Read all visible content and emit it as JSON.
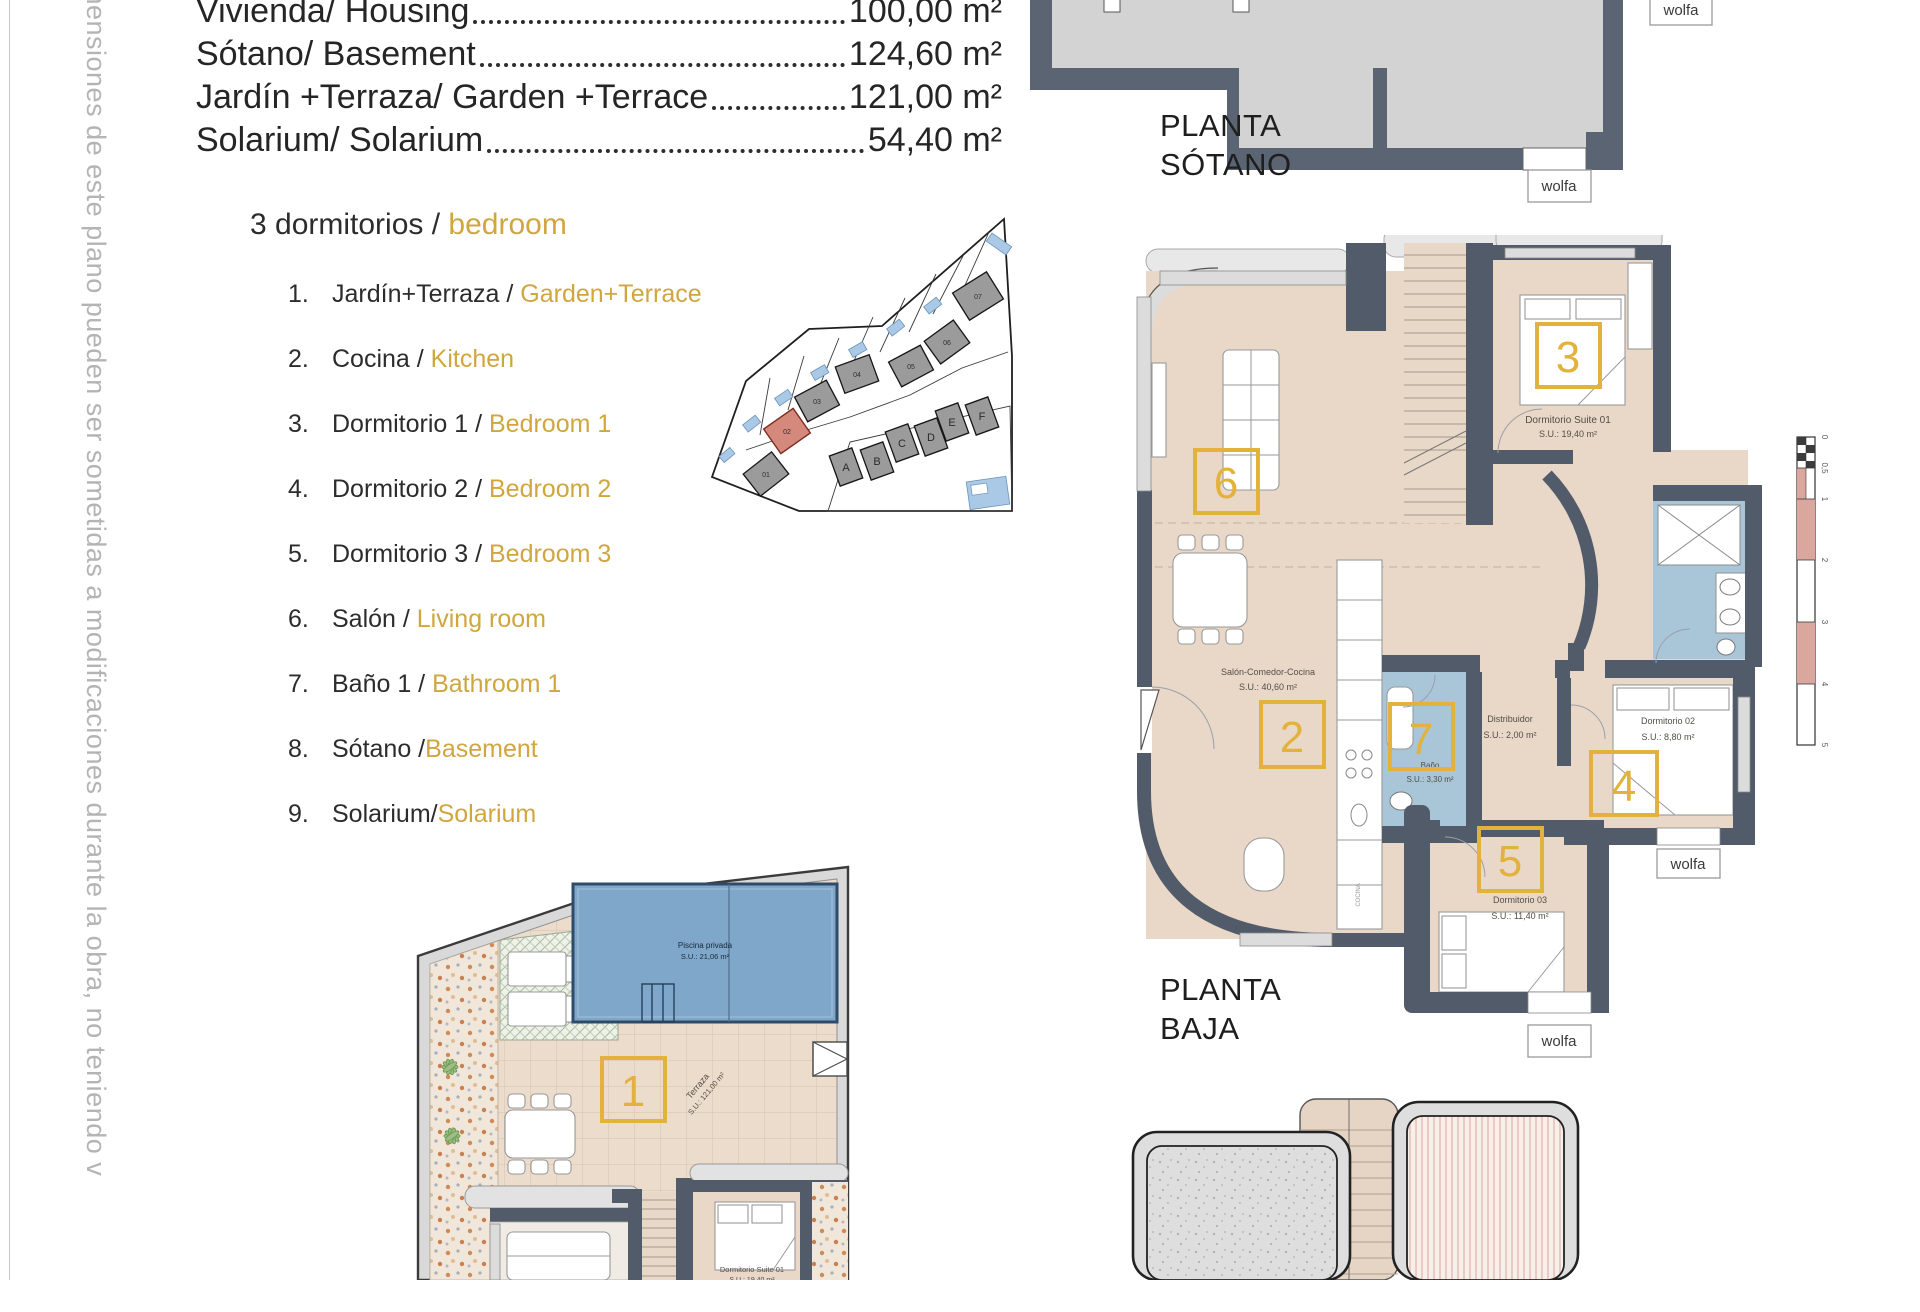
{
  "side_note": "mensiones de este plano pueden ser sometidas a modificaciones durante la obra, no teniendo v",
  "wolfa_label": "wolfa",
  "area_summary": {
    "rows": [
      {
        "label": "Vivienda/ Housing",
        "value": "100,00 m²"
      },
      {
        "label": "Sótano/ Basement",
        "value": "124,60 m²"
      },
      {
        "label": "Jardín +Terraza/ Garden +Terrace",
        "value": "121,00 m²"
      },
      {
        "label": "Solarium/ Solarium",
        "value": "54,40 m²"
      }
    ]
  },
  "legend": {
    "title_es": "3 dormitorios / ",
    "title_en": "bedroom",
    "items": [
      {
        "num": "1.",
        "es": "Jardín+Terraza / ",
        "en": "Garden+Terrace"
      },
      {
        "num": "2.",
        "es": "Cocina / ",
        "en": "Kitchen"
      },
      {
        "num": "3.",
        "es": "Dormitorio 1 / ",
        "en": "Bedroom 1"
      },
      {
        "num": "4.",
        "es": "Dormitorio 2 / ",
        "en": "Bedroom 2"
      },
      {
        "num": "5.",
        "es": "Dormitorio 3 / ",
        "en": "Bedroom 3"
      },
      {
        "num": "6.",
        "es": "Salón / ",
        "en": "Living room"
      },
      {
        "num": "7.",
        "es": "Baño 1 / ",
        "en": "Bathroom 1"
      },
      {
        "num": "8.",
        "es": "Sótano /",
        "en": "Basement"
      },
      {
        "num": "9.",
        "es": "Solarium/",
        "en": "Solarium"
      }
    ]
  },
  "site_map": {
    "plots": [
      "01",
      "02",
      "03",
      "04",
      "05",
      "06",
      "07"
    ],
    "units": [
      "A",
      "B",
      "C",
      "D",
      "E",
      "F"
    ]
  },
  "floors": {
    "basement": {
      "line1": "PLANTA",
      "line2": "SÓTANO"
    },
    "ground": {
      "line1": "PLANTA",
      "line2": "BAJA"
    }
  },
  "ground_rooms": {
    "living": {
      "box": "6"
    },
    "kitchen": {
      "box": "2",
      "vertical_label": "COCINA"
    },
    "suite": {
      "box": "3",
      "name": "Dormitorio Suite 01",
      "area": "S.U.: 19,40 m²"
    },
    "salon": {
      "name": "Salón-Comedor-Cocina",
      "area": "S.U.: 40,60 m²"
    },
    "distribuidor": {
      "name": "Distribuidor",
      "area": "S.U.: 2,00 m²"
    },
    "bano": {
      "box": "7",
      "name": "Baño",
      "area": "S.U.: 3,30 m²"
    },
    "dorm2": {
      "box": "4",
      "name": "Dormitorio 02",
      "area": "S.U.: 8,80 m²"
    },
    "dorm3": {
      "box": "5",
      "name": "Dormitorio 03",
      "area": "S.U.: 11,40 m²"
    }
  },
  "garden": {
    "box": "1",
    "pool_name": "Piscina privada",
    "pool_area": "S.U.: 21,06 m²",
    "terrace_name": "Terraza",
    "terrace_area": "S.U.: 121,00 m²",
    "suite_name": "Dormitorio Suite 01",
    "suite_area": "S.U.: 19,40 m²"
  },
  "scale_bar": {
    "labels": [
      "0",
      "0,5",
      "1",
      "2",
      "3",
      "4",
      "5"
    ]
  },
  "colors": {
    "accent_yellow": "#e2b23c",
    "wall_slate": "#525b69",
    "floor_tan": "#e9d8c8",
    "bath_blue": "#a9c6d9",
    "pool_blue": "#7fa7ca",
    "highlight_red": "#d4897c",
    "legend_gold": "#d0a63e"
  }
}
